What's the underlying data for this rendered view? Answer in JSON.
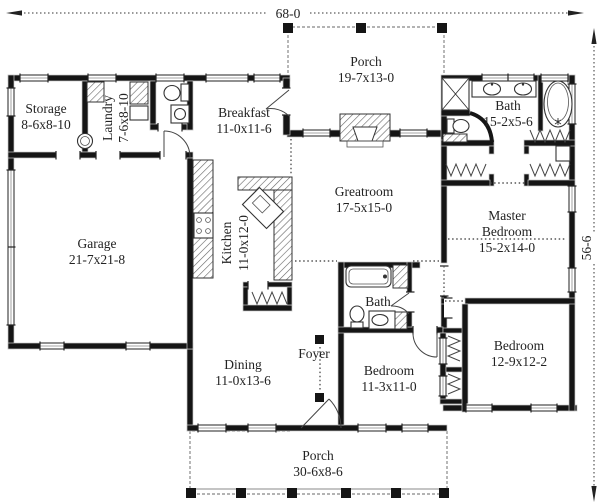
{
  "dimensions": {
    "width_label": "68-0",
    "height_label": "56-6"
  },
  "rooms": {
    "storage": {
      "name": "Storage",
      "dims": "8-6x8-10"
    },
    "laundry": {
      "name": "Laundry",
      "dims": "7-6x8-10"
    },
    "breakfast": {
      "name": "Breakfast",
      "dims": "11-0x11-6"
    },
    "porch_top": {
      "name": "Porch",
      "dims": "19-7x13-0"
    },
    "bath_master": {
      "name": "Bath",
      "dims": "15-2x5-6"
    },
    "garage": {
      "name": "Garage",
      "dims": "21-7x21-8"
    },
    "kitchen": {
      "name": "Kitchen",
      "dims": "11-0x12-0"
    },
    "greatroom": {
      "name": "Greatroom",
      "dims": "17-5x15-0"
    },
    "master_bedroom": {
      "name_line1": "Master",
      "name_line2": "Bedroom",
      "dims": "15-2x14-0"
    },
    "bath_hall": {
      "name": "Bath"
    },
    "dining": {
      "name": "Dining",
      "dims": "11-0x13-6"
    },
    "foyer": {
      "name": "Foyer"
    },
    "bedroom_small": {
      "name": "Bedroom",
      "dims": "11-3x11-0"
    },
    "bedroom_corner": {
      "name": "Bedroom",
      "dims": "12-9x12-2"
    },
    "porch_bottom": {
      "name": "Porch",
      "dims": "30-6x8-6"
    }
  },
  "colors": {
    "wall": "#151515",
    "text": "#222222",
    "porch_outline": "#9a9a9a",
    "background": "#ffffff"
  }
}
